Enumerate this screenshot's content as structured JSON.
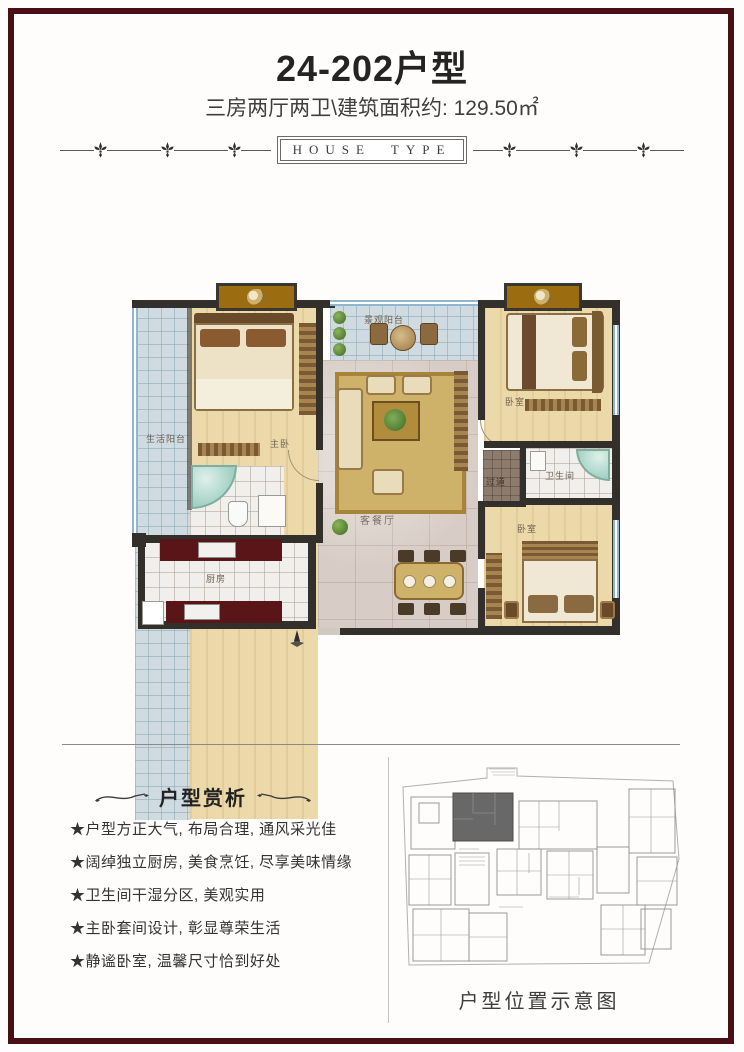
{
  "page": {
    "title": "24-202户型",
    "subtitle": "三房两厅两卫\\建筑面积约: 129.50㎡",
    "banner": "HOUSE TYPE"
  },
  "floorplan": {
    "labels": {
      "life_balcony": "生活阳台",
      "master_bedroom": "主卧",
      "view_balcony": "景观阳台",
      "bedroom_top": "卧室",
      "bathroom": "卫生间",
      "corridor": "过道",
      "living_dining": "客餐厅",
      "kitchen": "厨房",
      "bedroom_bottom": "卧室"
    }
  },
  "analysis": {
    "heading": "户型赏析",
    "points": [
      "★户型方正大气, 布局合理, 通风采光佳",
      "★阔绰独立厨房, 美食烹饪, 尽享美味情缘",
      "★卫生间干湿分区, 美观实用",
      "★主卧套间设计, 彰显尊荣生活",
      "★静谧卧室, 温馨尺寸恰到好处"
    ]
  },
  "siteplan": {
    "caption": "户型位置示意图"
  },
  "colors": {
    "frame_border": "#4a0f14",
    "walls": "#33302c",
    "wood_floor": "#ecd9a9",
    "balcony_tile": "#cfdbe1",
    "marble_floor": "#d8cdc6",
    "bay_gold": "#9c6c10",
    "kitchen_counter": "#5a1519",
    "site_highlight": "#686868"
  }
}
